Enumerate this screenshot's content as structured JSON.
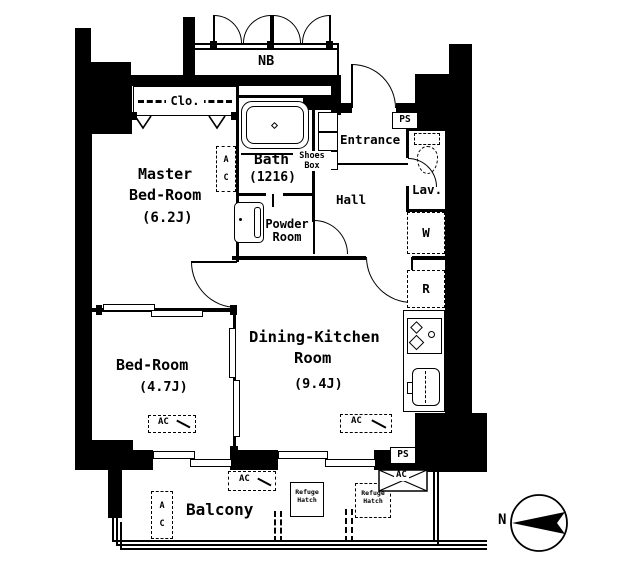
{
  "floorplan": {
    "nb": "NB",
    "closet": "Clo.",
    "master": {
      "l1": "Master",
      "l2": "Bed-Room",
      "size": "(6.2J)",
      "ac1": "A",
      "ac2": "C"
    },
    "bath": {
      "name": "Bath",
      "size": "(1216)"
    },
    "powder": {
      "l1": "Powder",
      "l2": "Room"
    },
    "shoes": {
      "l1": "Shoes",
      "l2": "Box"
    },
    "entrance": "Entrance",
    "hall": "Hall",
    "lav": "Lav.",
    "ps_top": "PS",
    "ps_bottom": "PS",
    "washer": "W",
    "fridge": "R",
    "dk": {
      "l1": "Dining-Kitchen",
      "l2": "Room",
      "size": "(9.4J)",
      "ac": "AC"
    },
    "bedroom": {
      "name": "Bed-Room",
      "size": "(4.7J)",
      "ac": "AC"
    },
    "balcony": {
      "name": "Balcony",
      "ac_top": "AC",
      "ac1": "A",
      "ac2": "C",
      "ac_unit": "AC"
    },
    "hatch1": {
      "l1": "Refuge",
      "l2": "Hatch"
    },
    "hatch2": {
      "l1": "Refuge",
      "l2": "Hatch"
    },
    "compass_n": "N"
  }
}
